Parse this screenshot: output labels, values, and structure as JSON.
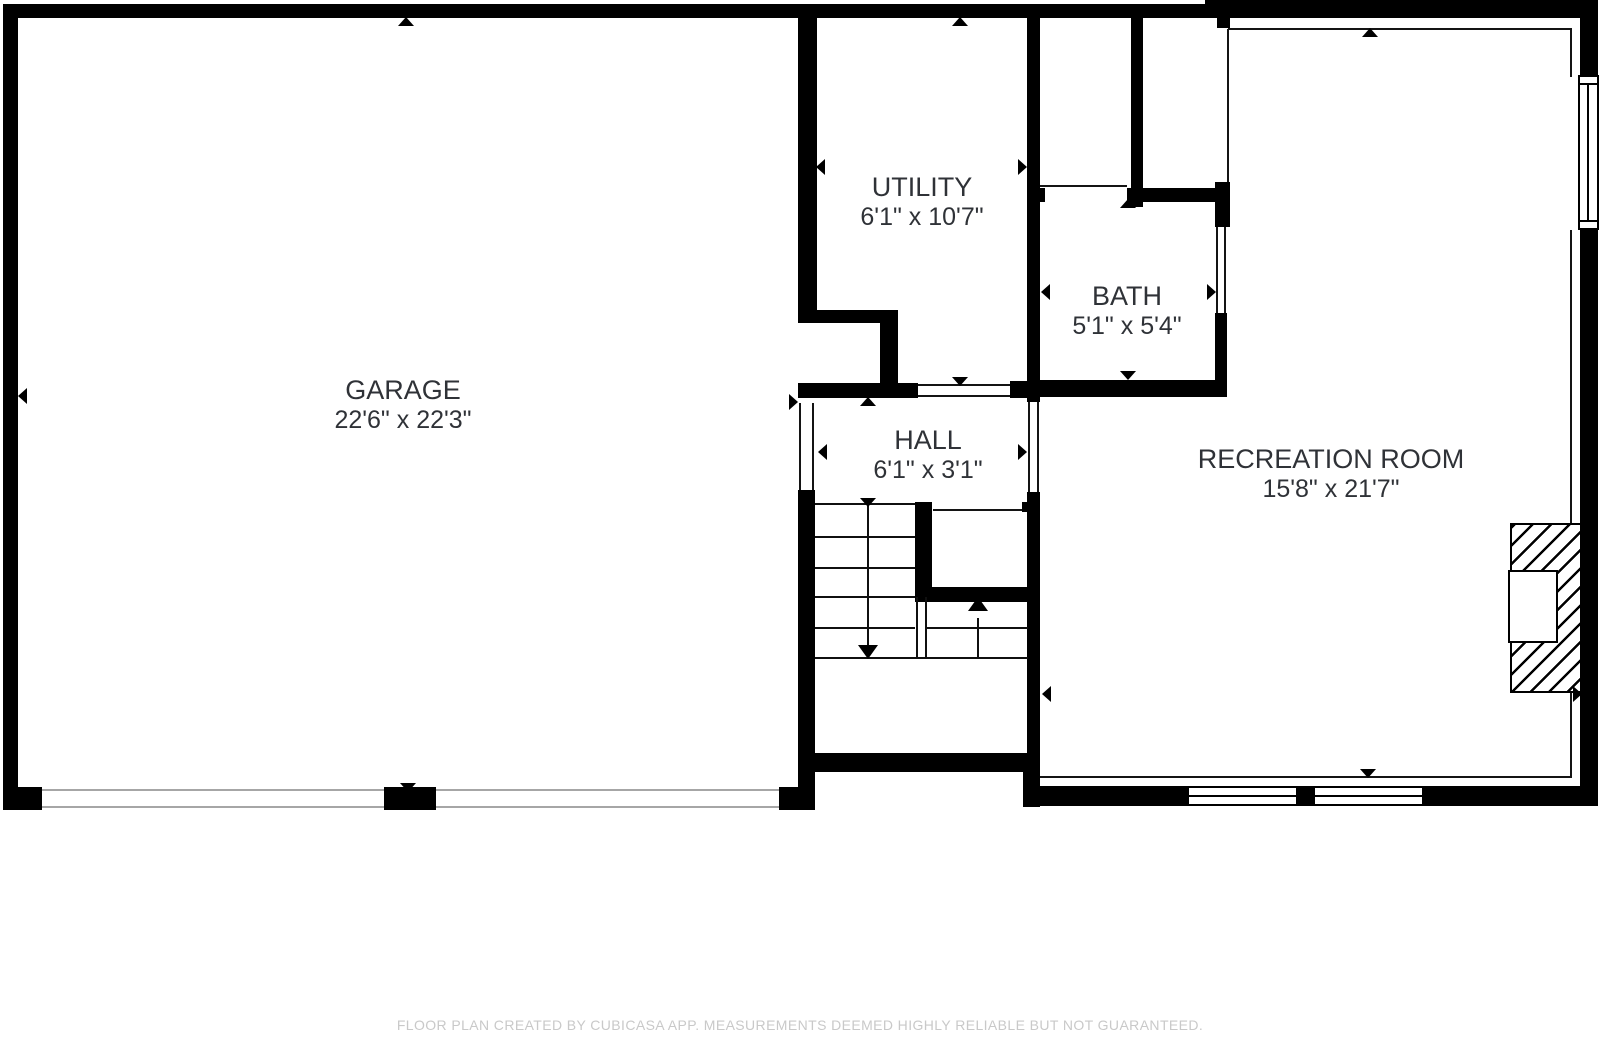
{
  "plan": {
    "rooms": [
      {
        "id": "garage",
        "name": "GARAGE",
        "dimensions": "22'6\" x 22'3\"",
        "cx": 403,
        "cy": 387
      },
      {
        "id": "utility",
        "name": "UTILITY",
        "dimensions": "6'1\" x 10'7\"",
        "cx": 922,
        "cy": 184
      },
      {
        "id": "bath",
        "name": "BATH",
        "dimensions": "5'1\" x 5'4\"",
        "cx": 1127,
        "cy": 293
      },
      {
        "id": "hall",
        "name": "HALL",
        "dimensions": "6'1\" x 3'1\"",
        "cx": 928,
        "cy": 437
      },
      {
        "id": "recreation_room",
        "name": "RECREATION ROOM",
        "dimensions": "15'8\" x 21'7\"",
        "cx": 1331,
        "cy": 456
      }
    ],
    "footer_text": "FLOOR PLAN CREATED BY CUBICASA APP. MEASUREMENTS DEEMED HIGHLY RELIABLE BUT NOT GUARANTEED.",
    "colors": {
      "wall": "#000000",
      "label": "#2f3237",
      "footer": "#c9c9c9",
      "door_line": "#a6a6a6",
      "thin_line": "#141414",
      "background": "#ffffff"
    }
  }
}
